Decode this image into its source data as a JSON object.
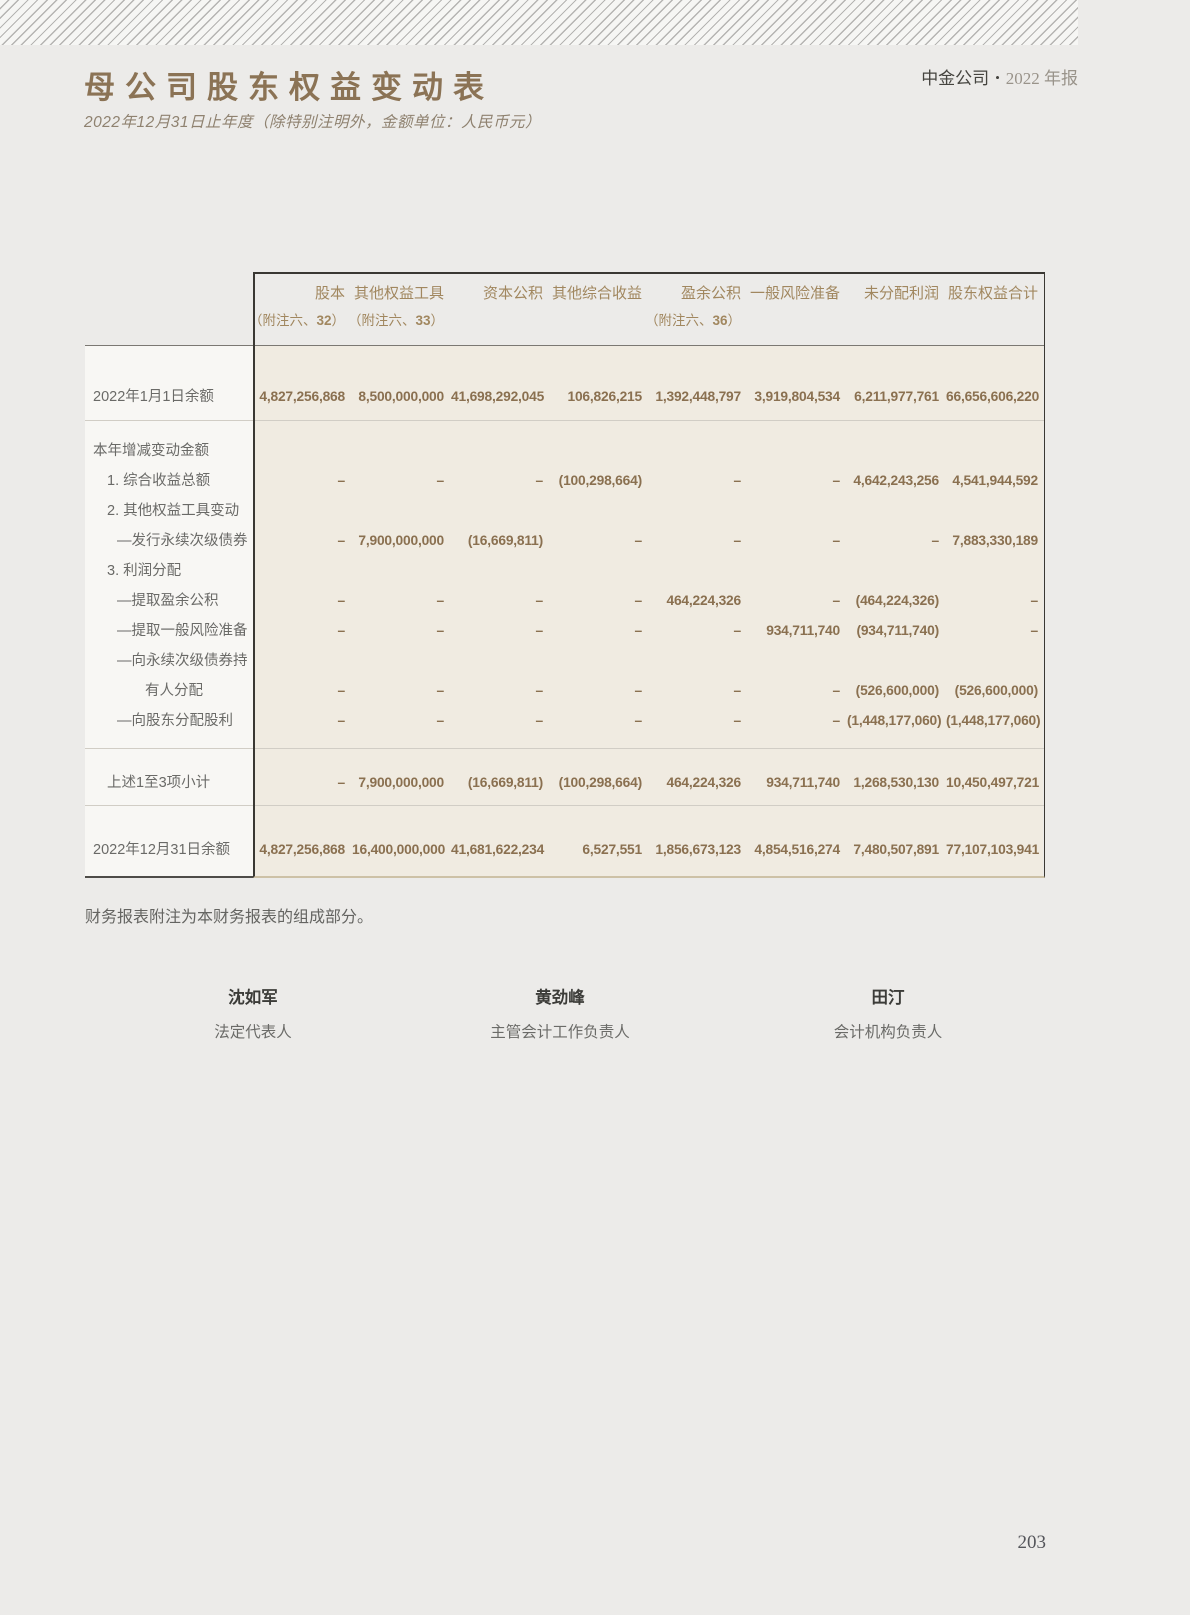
{
  "header": {
    "title": "母公司股东权益变动表",
    "brand": "中金公司",
    "bullet": "•",
    "report": "2022 年报",
    "subtitle": "2022年12月31日止年度（除特别注明外，金额单位：人民币元）"
  },
  "table": {
    "columns": [
      {
        "title": "股本",
        "note_pre": "（附注六、",
        "note_num": "32",
        "note_post": "）"
      },
      {
        "title": "其他权益工具",
        "note_pre": "（附注六、",
        "note_num": "33",
        "note_post": "）"
      },
      {
        "title": "资本公积"
      },
      {
        "title": "其他综合收益"
      },
      {
        "title": "盈余公积",
        "note_pre": "（附注六、",
        "note_num": "36",
        "note_post": "）"
      },
      {
        "title": "一般风险准备"
      },
      {
        "title": "未分配利润"
      },
      {
        "title": "股东权益合计"
      }
    ],
    "opening": {
      "label": "2022年1月1日余额",
      "values": [
        "4,827,256,868",
        "8,500,000,000",
        "41,698,292,045",
        "106,826,215",
        "1,392,448,797",
        "3,919,804,534",
        "6,211,977,761",
        "66,656,606,220"
      ]
    },
    "body_rows": [
      {
        "label": "本年增减变动金额"
      },
      {
        "label": "1. 综合收益总额",
        "values": [
          "–",
          "–",
          "–",
          "(100,298,664)",
          "–",
          "–",
          "4,642,243,256",
          "4,541,944,592"
        ]
      },
      {
        "label": "2. 其他权益工具变动"
      },
      {
        "label": "—发行永续次级债券",
        "values": [
          "–",
          "7,900,000,000",
          "(16,669,811)",
          "–",
          "–",
          "–",
          "–",
          "7,883,330,189"
        ]
      },
      {
        "label": "3. 利润分配"
      },
      {
        "label": "—提取盈余公积",
        "values": [
          "–",
          "–",
          "–",
          "–",
          "464,224,326",
          "–",
          "(464,224,326)",
          "–"
        ]
      },
      {
        "label": "—提取一般风险准备",
        "values": [
          "–",
          "–",
          "–",
          "–",
          "–",
          "934,711,740",
          "(934,711,740)",
          "–"
        ]
      },
      {
        "label": "—向永续次级债券持"
      },
      {
        "label": "有人分配",
        "values": [
          "–",
          "–",
          "–",
          "–",
          "–",
          "–",
          "(526,600,000)",
          "(526,600,000)"
        ]
      },
      {
        "label": "—向股东分配股利",
        "values": [
          "–",
          "–",
          "–",
          "–",
          "–",
          "–",
          "(1,448,177,060)",
          "(1,448,177,060)"
        ]
      }
    ],
    "subtotal": {
      "label": "上述1至3项小计",
      "values": [
        "–",
        "7,900,000,000",
        "(16,669,811)",
        "(100,298,664)",
        "464,224,326",
        "934,711,740",
        "1,268,530,130",
        "10,450,497,721"
      ]
    },
    "closing": {
      "label": "2022年12月31日余额",
      "values": [
        "4,827,256,868",
        "16,400,000,000",
        "41,681,622,234",
        "6,527,551",
        "1,856,673,123",
        "4,854,516,274",
        "7,480,507,891",
        "77,107,103,941"
      ]
    }
  },
  "footer": {
    "note": "财务报表附注为本财务报表的组成部分。"
  },
  "signatures": [
    {
      "name": "沈如军",
      "role": "法定代表人"
    },
    {
      "name": "黄劲峰",
      "role": "主管会计工作负责人"
    },
    {
      "name": "田汀",
      "role": "会计机构负责人"
    }
  ],
  "page_number": "203"
}
